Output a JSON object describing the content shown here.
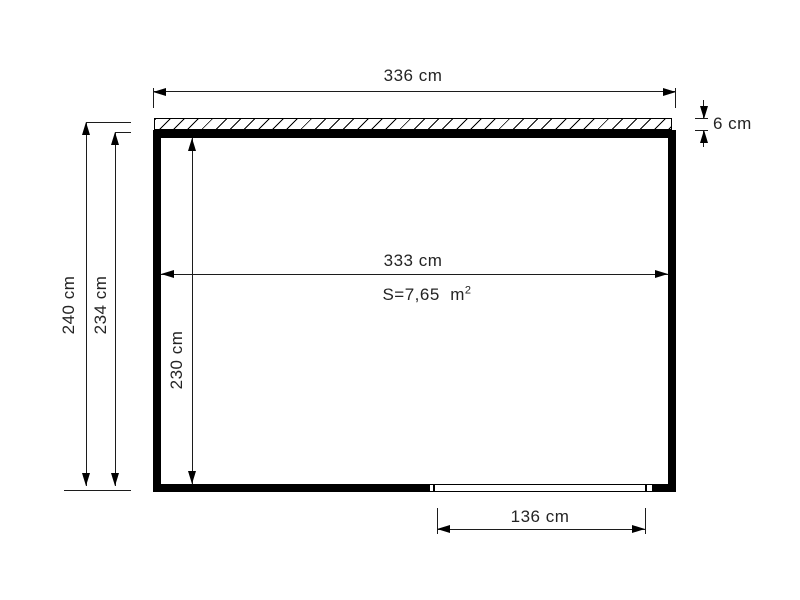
{
  "diagram": {
    "type": "floor-plan",
    "background_color": "#ffffff",
    "line_color": "#000000",
    "text_color": "#242424",
    "dimensions": {
      "outer_width": {
        "label": "336 cm",
        "value": 336,
        "unit": "cm"
      },
      "roof_thickness": {
        "label": "6 cm",
        "value": 6,
        "unit": "cm"
      },
      "outer_height": {
        "label": "240 cm",
        "value": 240,
        "unit": "cm"
      },
      "wall_height": {
        "label": "234 cm",
        "value": 234,
        "unit": "cm"
      },
      "inner_width": {
        "label": "333 cm",
        "value": 333,
        "unit": "cm"
      },
      "inner_height": {
        "label": "230 cm",
        "value": 230,
        "unit": "cm"
      },
      "door_width": {
        "label": "136 cm",
        "value": 136,
        "unit": "cm"
      }
    },
    "area": {
      "label": "S=7,65",
      "unit": "m",
      "exponent": "2",
      "value_m2": 7.65
    }
  }
}
